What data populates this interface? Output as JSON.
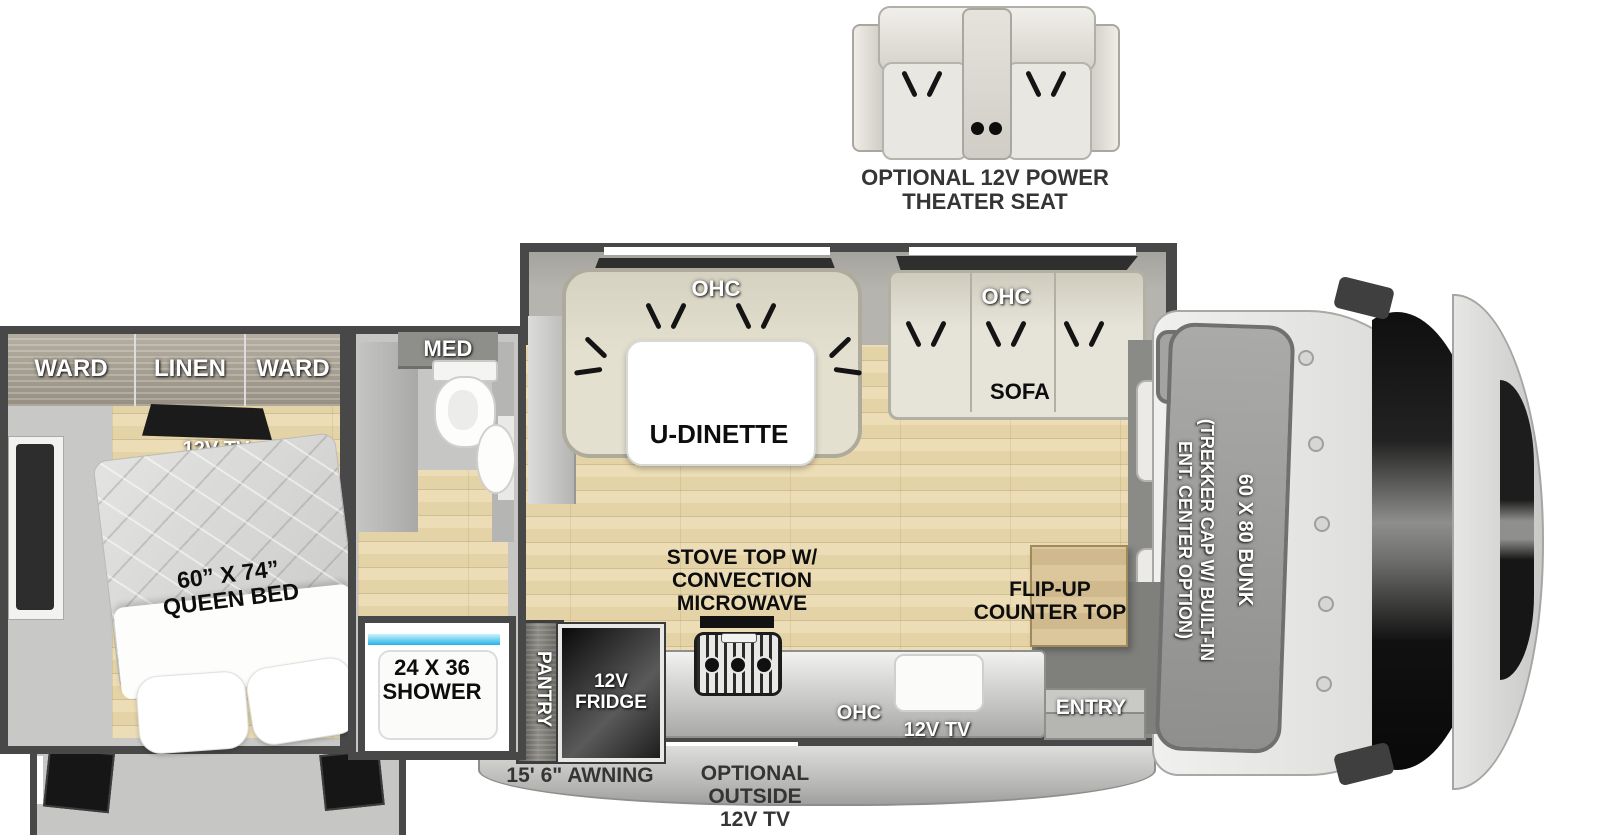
{
  "theater": {
    "line1": "OPTIONAL 12V POWER",
    "line2": "THEATER SEAT"
  },
  "bedroom": {
    "ward_left": "WARD",
    "linen": "LINEN",
    "ward_right": "WARD",
    "tv": "12V TV",
    "bed_size": "60” X 74”",
    "bed_name": "QUEEN BED"
  },
  "bathroom": {
    "med": "MED"
  },
  "shower": {
    "size": "24 X 36",
    "name": "SHOWER"
  },
  "dinette": {
    "ohc": "OHC",
    "name": "U-DINETTE"
  },
  "sofa": {
    "ohc": "OHC",
    "name": "SOFA"
  },
  "kitchen": {
    "stove1": "STOVE TOP W/",
    "stove2": "CONVECTION",
    "stove3": "MICROWAVE",
    "pantry": "PANTRY",
    "fridge1": "12V",
    "fridge2": "FRIDGE",
    "ohc": "OHC",
    "tv": "12V TV",
    "flip1": "FLIP-UP",
    "flip2": "COUNTER TOP"
  },
  "entry": {
    "label": "ENTRY"
  },
  "front": {
    "bunk": "60 X 80 BUNK",
    "trekker1": "(TREKKER CAP W/ BUILT-IN",
    "trekker2": "ENT. CENTER OPTION)"
  },
  "exterior": {
    "awning": "15' 6\" AWNING",
    "tv1": "OPTIONAL OUTSIDE",
    "tv2": "12V TV"
  },
  "colors": {
    "wall": "#484848",
    "wood_floor": "#e6d6ac",
    "upholstery": "#e0dccc",
    "shower_blue": "#29b9e8"
  }
}
